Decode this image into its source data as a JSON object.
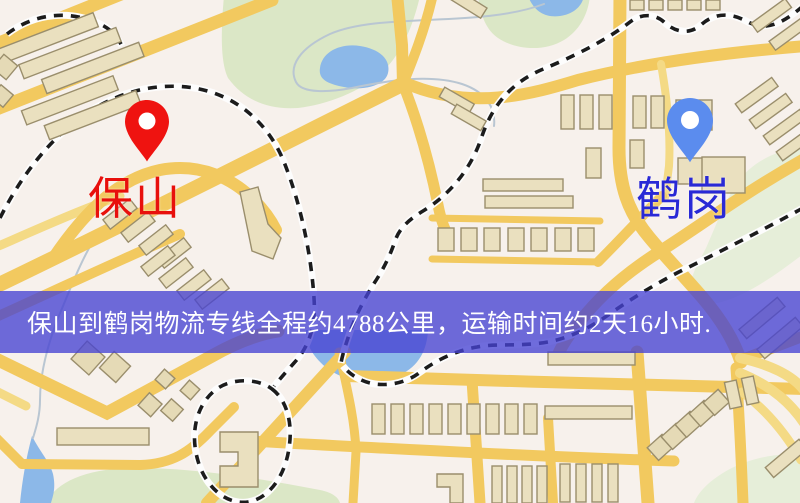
{
  "map": {
    "origin": {
      "label": "保山",
      "pin_color": "#ef1310",
      "label_color": "#e8100c"
    },
    "destination": {
      "label": "鹤岗",
      "pin_color": "#5b8cee",
      "label_color": "#2929d6"
    },
    "banner": {
      "text": "保山到鹤岗物流专线全程约4788公里，运输时间约2天16小时.",
      "distance_text": "约4788公里",
      "duration_text": "约2天16小时",
      "background": "rgba(70,66,210,0.78)",
      "text_color": "#ffffff"
    },
    "palette": {
      "base": "#f7f1ec",
      "road": "#f2c95f",
      "road_minor": "#f4da85",
      "building": "#eae0bf",
      "building_outline": "#9a8e6c",
      "park": "#dbe7c6",
      "water": "#8cb8e8",
      "railway": "#1c1c1c"
    }
  }
}
